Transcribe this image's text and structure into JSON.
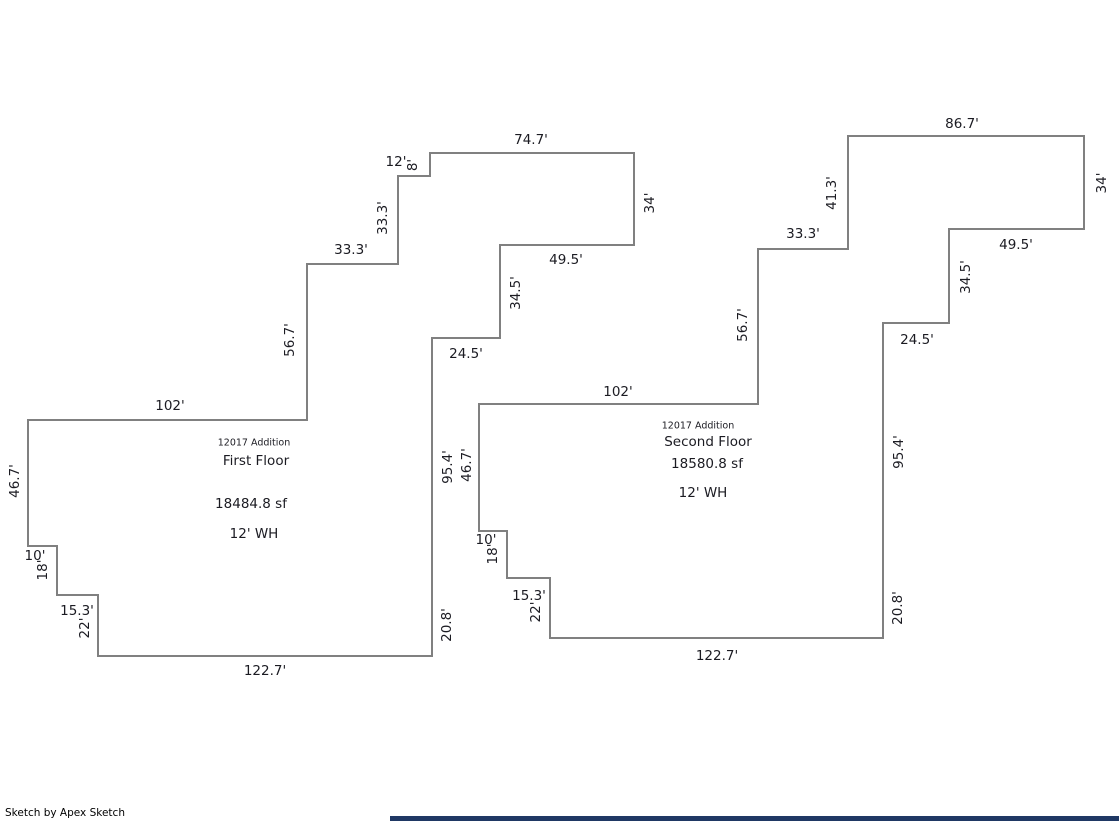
{
  "page": {
    "background": "#ffffff",
    "wall_color": "#808080",
    "text_color": "#1b1b22"
  },
  "footer": {
    "credit": "Sketch by Apex Sketch"
  },
  "bottom_bar": {
    "color": "#1f3864"
  },
  "floors": [
    {
      "id": "first-floor",
      "info": {
        "addition": {
          "text": "12017 Addition",
          "x": 254,
          "y": 443
        },
        "name": {
          "text": "First Floor",
          "x": 256,
          "y": 461
        },
        "area": {
          "text": "18484.8 sf",
          "x": 251,
          "y": 504
        },
        "wall_height": {
          "text": "12' WH",
          "x": 254,
          "y": 534
        }
      },
      "outline": [
        [
          430,
          153
        ],
        [
          634,
          153
        ],
        [
          634,
          245
        ],
        [
          500,
          245
        ],
        [
          500,
          338
        ],
        [
          432,
          338
        ],
        [
          432,
          656
        ],
        [
          98,
          656
        ],
        [
          98,
          595
        ],
        [
          57,
          595
        ],
        [
          57,
          546
        ],
        [
          28,
          546
        ],
        [
          28,
          420
        ],
        [
          307,
          420
        ],
        [
          307,
          264
        ],
        [
          398,
          264
        ],
        [
          398,
          176
        ],
        [
          430,
          176
        ]
      ],
      "dimensions": [
        {
          "text": "74.7'",
          "x": 531,
          "y": 140,
          "rotate": 0
        },
        {
          "text": "12'",
          "x": 396,
          "y": 162,
          "rotate": 0
        },
        {
          "text": "8'",
          "x": 413,
          "y": 165,
          "rotate": -90
        },
        {
          "text": "34'",
          "x": 650,
          "y": 203,
          "rotate": -90
        },
        {
          "text": "49.5'",
          "x": 566,
          "y": 260,
          "rotate": 0
        },
        {
          "text": "34.5'",
          "x": 516,
          "y": 293,
          "rotate": -90
        },
        {
          "text": "24.5'",
          "x": 466,
          "y": 354,
          "rotate": 0
        },
        {
          "text": "33.3'",
          "x": 383,
          "y": 218,
          "rotate": -90
        },
        {
          "text": "33.3'",
          "x": 351,
          "y": 250,
          "rotate": 0
        },
        {
          "text": "56.7'",
          "x": 290,
          "y": 340,
          "rotate": -90
        },
        {
          "text": "102'",
          "x": 170,
          "y": 406,
          "rotate": 0
        },
        {
          "text": "46.7'",
          "x": 15,
          "y": 481,
          "rotate": -90
        },
        {
          "text": "10'",
          "x": 35,
          "y": 556,
          "rotate": 0
        },
        {
          "text": "18'",
          "x": 43,
          "y": 570,
          "rotate": -90
        },
        {
          "text": "15.3'",
          "x": 77,
          "y": 611,
          "rotate": 0
        },
        {
          "text": "22'",
          "x": 85,
          "y": 628,
          "rotate": -90
        },
        {
          "text": "122.7'",
          "x": 265,
          "y": 671,
          "rotate": 0
        },
        {
          "text": "20.8'",
          "x": 447,
          "y": 625,
          "rotate": -90
        },
        {
          "text": "95.4'",
          "x": 448,
          "y": 467,
          "rotate": -90
        }
      ]
    },
    {
      "id": "second-floor",
      "info": {
        "addition": {
          "text": "12017 Addition",
          "x": 698,
          "y": 426
        },
        "name": {
          "text": "Second Floor",
          "x": 708,
          "y": 442
        },
        "area": {
          "text": "18580.8 sf",
          "x": 707,
          "y": 464
        },
        "wall_height": {
          "text": "12' WH",
          "x": 703,
          "y": 493
        }
      },
      "outline": [
        [
          848,
          136
        ],
        [
          1084,
          136
        ],
        [
          1084,
          229
        ],
        [
          949,
          229
        ],
        [
          949,
          323
        ],
        [
          883,
          323
        ],
        [
          883,
          638
        ],
        [
          550,
          638
        ],
        [
          550,
          578
        ],
        [
          507,
          578
        ],
        [
          507,
          531
        ],
        [
          479,
          531
        ],
        [
          479,
          404
        ],
        [
          758,
          404
        ],
        [
          758,
          249
        ],
        [
          848,
          249
        ]
      ],
      "dimensions": [
        {
          "text": "86.7'",
          "x": 962,
          "y": 124,
          "rotate": 0
        },
        {
          "text": "34'",
          "x": 1102,
          "y": 183,
          "rotate": -90
        },
        {
          "text": "49.5'",
          "x": 1016,
          "y": 245,
          "rotate": 0
        },
        {
          "text": "34.5'",
          "x": 966,
          "y": 277,
          "rotate": -90
        },
        {
          "text": "24.5'",
          "x": 917,
          "y": 340,
          "rotate": 0
        },
        {
          "text": "95.4'",
          "x": 899,
          "y": 452,
          "rotate": -90
        },
        {
          "text": "20.8'",
          "x": 898,
          "y": 608,
          "rotate": -90
        },
        {
          "text": "122.7'",
          "x": 717,
          "y": 656,
          "rotate": 0
        },
        {
          "text": "22'",
          "x": 536,
          "y": 612,
          "rotate": -90
        },
        {
          "text": "15.3'",
          "x": 529,
          "y": 596,
          "rotate": 0
        },
        {
          "text": "18'",
          "x": 493,
          "y": 554,
          "rotate": -90
        },
        {
          "text": "10'",
          "x": 486,
          "y": 540,
          "rotate": 0
        },
        {
          "text": "46.7'",
          "x": 467,
          "y": 465,
          "rotate": -90
        },
        {
          "text": "102'",
          "x": 618,
          "y": 392,
          "rotate": 0
        },
        {
          "text": "56.7'",
          "x": 743,
          "y": 325,
          "rotate": -90
        },
        {
          "text": "33.3'",
          "x": 803,
          "y": 234,
          "rotate": 0
        },
        {
          "text": "41.3'",
          "x": 832,
          "y": 193,
          "rotate": -90
        }
      ]
    }
  ]
}
